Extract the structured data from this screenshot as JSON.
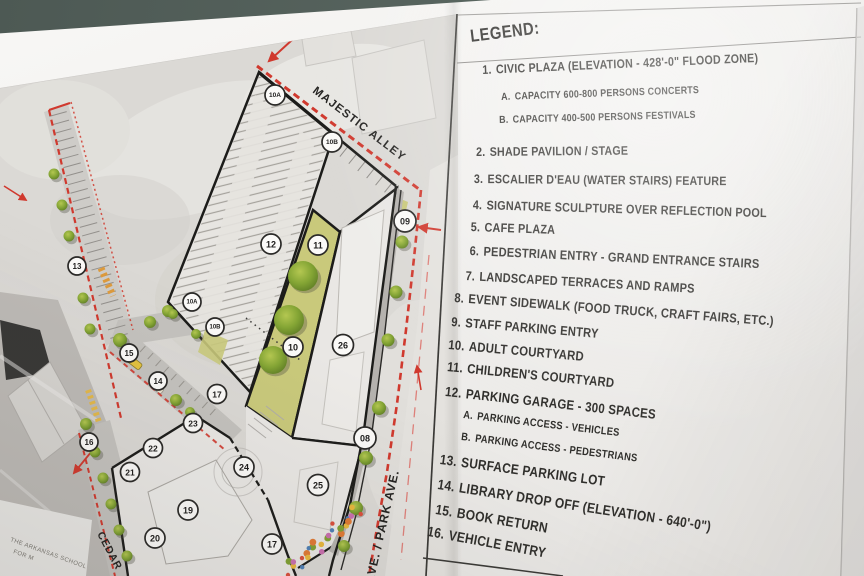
{
  "legend": {
    "title": "LEGEND:",
    "items": [
      {
        "n": "1.",
        "t": "CIVIC PLAZA (ELEVATION - 428'-0\" FLOOD ZONE)",
        "sub": [
          {
            "n": "A.",
            "t": "CAPACITY 600-800 PERSONS CONCERTS"
          },
          {
            "n": "B.",
            "t": "CAPACITY 400-500 PERSONS FESTIVALS"
          }
        ]
      },
      {
        "n": "2.",
        "t": "SHADE PAVILION / STAGE"
      },
      {
        "n": "3.",
        "t": "ESCALIER D'EAU (WATER STAIRS) FEATURE"
      },
      {
        "n": "4.",
        "t": "SIGNATURE SCULPTURE OVER REFLECTION POOL"
      },
      {
        "n": "5.",
        "t": "CAFE PLAZA"
      },
      {
        "n": "6.",
        "t": "PEDESTRIAN ENTRY - GRAND ENTRANCE STAIRS"
      },
      {
        "n": "7.",
        "t": "LANDSCAPED TERRACES AND RAMPS"
      },
      {
        "n": "8.",
        "t": "EVENT SIDEWALK (FOOD TRUCK, CRAFT FAIRS, ETC.)"
      },
      {
        "n": "9.",
        "t": "STAFF PARKING ENTRY"
      },
      {
        "n": "10.",
        "t": "ADULT COURTYARD"
      },
      {
        "n": "11.",
        "t": "CHILDREN'S COURTYARD"
      },
      {
        "n": "12.",
        "t": "PARKING GARAGE - 300 SPACES",
        "sub": [
          {
            "n": "A.",
            "t": "PARKING ACCESS - VEHICLES"
          },
          {
            "n": "B.",
            "t": "PARKING ACCESS - PEDESTRIANS"
          }
        ]
      },
      {
        "n": "13.",
        "t": "SURFACE PARKING LOT"
      },
      {
        "n": "14.",
        "t": "LIBRARY DROP OFF (ELEVATION - 640'-0\")"
      },
      {
        "n": "15.",
        "t": "BOOK RETURN"
      },
      {
        "n": "16.",
        "t": "VEHICLE ENTRY"
      }
    ]
  },
  "map": {
    "street_labels": {
      "alley": "MAJESTIC ALLEY",
      "park": "AVE. / PARK AVE.",
      "cedar": "CEDAR"
    },
    "school_label": {
      "line1": "THE ARKANSAS SCHOOL",
      "line2": "FOR M"
    },
    "markers": [
      {
        "label": "10A",
        "x": 275,
        "y": 95,
        "r": 10,
        "fs": 6.5
      },
      {
        "label": "10B",
        "x": 332,
        "y": 142,
        "r": 10,
        "fs": 6.5
      },
      {
        "label": "09",
        "x": 405,
        "y": 221,
        "r": 11,
        "fs": 9
      },
      {
        "label": "12",
        "x": 271,
        "y": 244,
        "r": 10,
        "fs": 9
      },
      {
        "label": "11",
        "x": 318,
        "y": 245,
        "r": 10,
        "fs": 9
      },
      {
        "label": "13",
        "x": 77,
        "y": 266,
        "r": 9,
        "fs": 8
      },
      {
        "label": "10A",
        "x": 192,
        "y": 302,
        "r": 9,
        "fs": 6
      },
      {
        "label": "10B",
        "x": 215,
        "y": 327,
        "r": 9,
        "fs": 6
      },
      {
        "label": "15",
        "x": 129,
        "y": 353,
        "r": 9,
        "fs": 8
      },
      {
        "label": "10",
        "x": 293,
        "y": 347,
        "r": 10,
        "fs": 9
      },
      {
        "label": "26",
        "x": 343,
        "y": 345,
        "r": 10.5,
        "fs": 9
      },
      {
        "label": "14",
        "x": 158,
        "y": 381,
        "r": 9,
        "fs": 8
      },
      {
        "label": "17",
        "x": 217,
        "y": 394,
        "r": 9.5,
        "fs": 8.5
      },
      {
        "label": "23",
        "x": 193,
        "y": 423,
        "r": 9.5,
        "fs": 8.5
      },
      {
        "label": "16",
        "x": 89,
        "y": 442,
        "r": 9,
        "fs": 8
      },
      {
        "label": "22",
        "x": 153,
        "y": 448,
        "r": 9.5,
        "fs": 8.5
      },
      {
        "label": "08",
        "x": 365,
        "y": 438,
        "r": 11,
        "fs": 9
      },
      {
        "label": "24",
        "x": 244,
        "y": 467,
        "r": 10,
        "fs": 9
      },
      {
        "label": "21",
        "x": 130,
        "y": 472,
        "r": 9.5,
        "fs": 8.5
      },
      {
        "label": "25",
        "x": 318,
        "y": 485,
        "r": 10.5,
        "fs": 9
      },
      {
        "label": "19",
        "x": 188,
        "y": 510,
        "r": 10,
        "fs": 9
      },
      {
        "label": "20",
        "x": 155,
        "y": 538,
        "r": 10,
        "fs": 9
      },
      {
        "label": "17",
        "x": 272,
        "y": 544,
        "r": 10,
        "fs": 9
      }
    ]
  },
  "colors": {
    "boundary_red": "#d0392e",
    "courtyard_yellow": "#c9c97b",
    "tree_green": "#7fa032",
    "wall_teal": "#566059"
  }
}
